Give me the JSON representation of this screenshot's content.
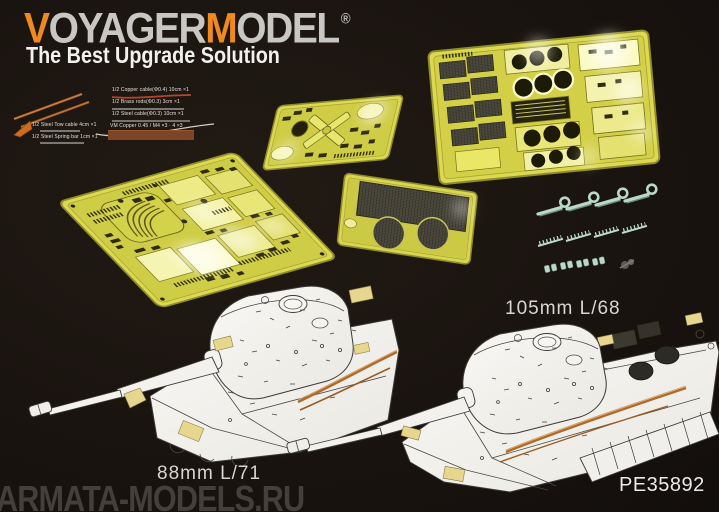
{
  "brand": {
    "logo": {
      "part1": "V",
      "part2": "OYAGER",
      "part3": "M",
      "part4": "ODEL"
    },
    "registered": "®",
    "tagline": "The Best Upgrade Solution",
    "accent_orange": "#F08A1E",
    "logo_silver": "#C9C7C3"
  },
  "callouts": {
    "lines": [
      "1/2 Copper cable(Φ0.4) 10cm ×1",
      "1/2 Brass rods(Φ0.3) 3cm ×1",
      "1/2 Steel cable(Φ0.3) 10cm ×1"
    ],
    "side_labels": [
      "1/2 Steel Tow cable 4cm ×1",
      "1/2 Steel Spring bar 1cm ×1"
    ],
    "swatch_label": "VM Copper 0.45 / M4 ×3 · 4 ×3"
  },
  "labels": {
    "gun_right": "105mm L/68",
    "gun_left": "88mm L/71",
    "product_code": "PE35892"
  },
  "watermark": {
    "text": "ARMATA-MODELS.RU"
  },
  "scene": {
    "frets": [
      {
        "name": "main-hull-fret"
      },
      {
        "name": "turret-detail-fret"
      },
      {
        "name": "engine-deck-grille-fret"
      },
      {
        "name": "mesh-screen-fret"
      }
    ],
    "hardware": {
      "tow_shackles": 4,
      "cleat_strips": 4,
      "clamp_pairs": 4,
      "misc_part": 1
    },
    "tanks": [
      {
        "name": "king-tiger-88mm",
        "gun": "88mm L/71"
      },
      {
        "name": "king-tiger-105mm",
        "gun": "105mm L/68"
      }
    ]
  },
  "colors": {
    "background": "#1A1410",
    "brass": "#DCD94F",
    "brass_bright": "#FBF9C0",
    "mesh_dark": "#413E34",
    "metal_mint": "#B9D8C7",
    "copper": "#AD6A2B",
    "tank_white": "#F2F1EE",
    "caption_gray": "#D8D6D2",
    "watermark_gray": "#4A443E",
    "swatch_brown": "#7B4526"
  }
}
